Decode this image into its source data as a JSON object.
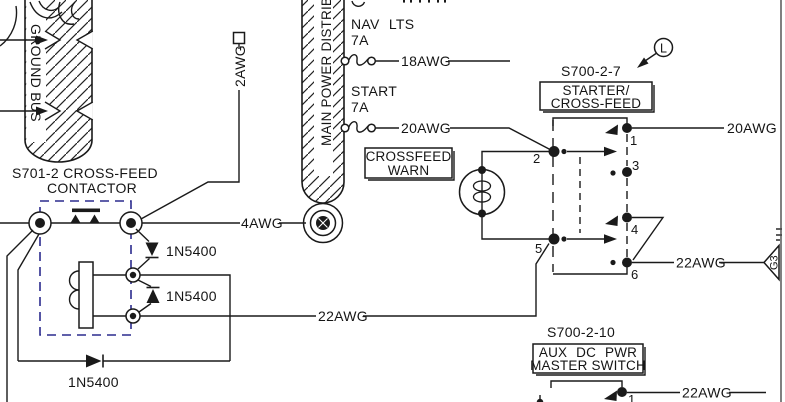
{
  "bus": {
    "ground": "GROUND BUS",
    "main_power": "MAIN POWER DISTRIBUT"
  },
  "contactor": {
    "ref": "S701-2 CROSS-FEED",
    "name": "CONTACTOR",
    "diode_top": "1N5400",
    "diode_mid": "1N5400",
    "diode_bottom": "1N5400"
  },
  "breakers": {
    "nav": {
      "name": "NAV LTS",
      "rating": "7A",
      "wire": "18AWG"
    },
    "start": {
      "name": "START",
      "rating": "7A",
      "wire": "20AWG"
    }
  },
  "warn": {
    "line1": "CROSSFEED",
    "line2": "WARN"
  },
  "wires": {
    "w2awg": "2AWG",
    "w4awg": "4AWG",
    "w22awg_main": "22AWG",
    "w20awg_sw": "20AWG",
    "w22awg_sw": "22AWG",
    "w22awg_aux": "22AWG"
  },
  "switch_starter": {
    "ref": "S700-2-7",
    "detail_letter": "L",
    "label1": "STARTER/",
    "label2": "CROSS-FEED",
    "t1": "1",
    "t2": "2",
    "t3": "3",
    "t4": "4",
    "t5": "5",
    "t6": "6"
  },
  "switch_aux": {
    "ref": "S700-2-10",
    "label1": "AUX DC PWR",
    "label2": "MASTER SWITCH",
    "t1": "1"
  },
  "flag": {
    "id": "G3"
  },
  "colors": {
    "line": "#1a1a1a",
    "contactor_box": "#2b2b8e",
    "background": "#ffffff"
  }
}
